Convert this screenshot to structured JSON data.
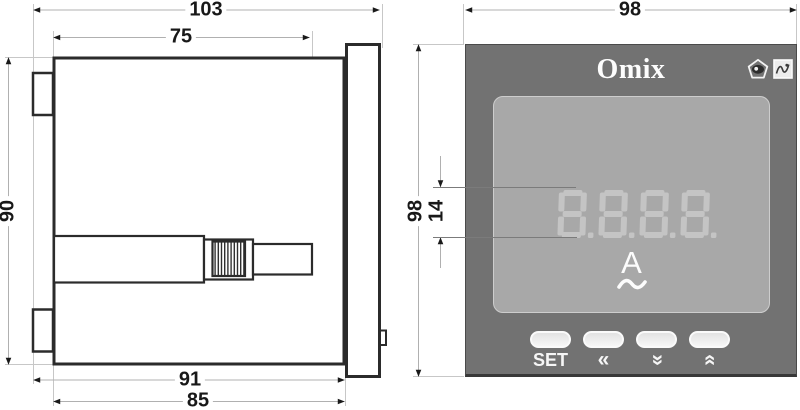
{
  "side_view": {
    "dims": {
      "total_depth": "103",
      "front_depth": "75",
      "height": "90",
      "depth_to_panel": "91",
      "body_depth": "85"
    }
  },
  "front_view": {
    "dims": {
      "width": "98",
      "height": "98",
      "digit_height": "14"
    },
    "brand": "Omix",
    "display_value": "8.8.8.8.",
    "unit_symbol": "A",
    "ac_symbol": "~",
    "buttons": [
      {
        "name": "set",
        "label": "SET"
      },
      {
        "name": "shift-left",
        "label": "«"
      },
      {
        "name": "decrease",
        "label": "«"
      },
      {
        "name": "increase",
        "label": "«"
      }
    ],
    "icons": {
      "pentagon_mark": "certification-pentagon-eye-icon",
      "square_mark": "certification-signature-icon"
    }
  },
  "colors": {
    "panel": "#727272",
    "display": "#a8a8a8",
    "digits": "#c4c4c4",
    "outline": "#2b2b2b",
    "dimline": "#b0b0b0"
  }
}
